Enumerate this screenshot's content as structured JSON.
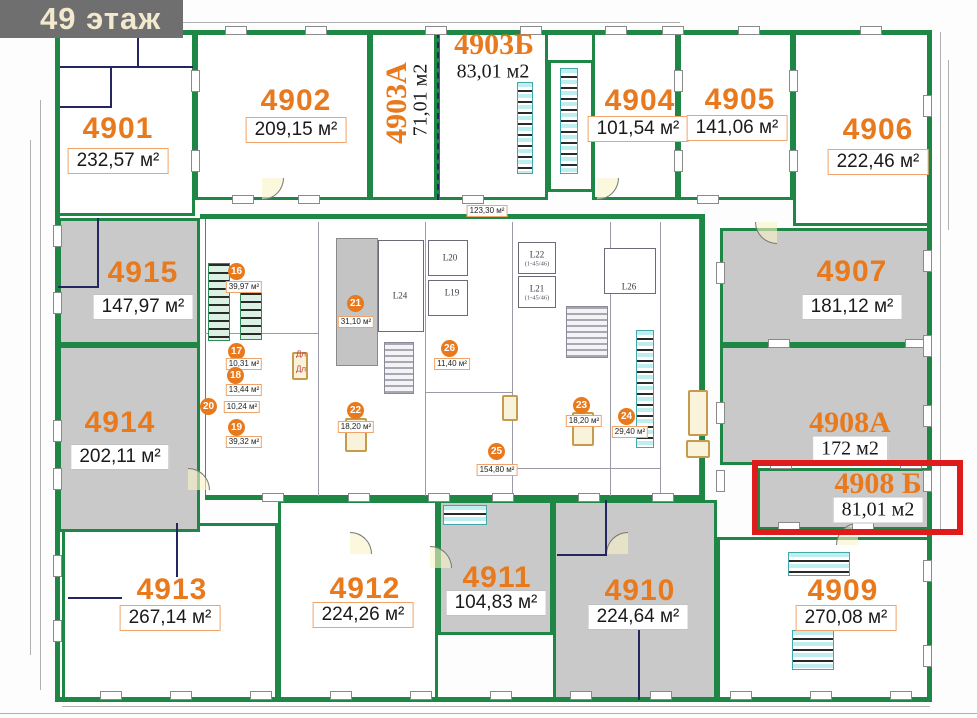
{
  "header": {
    "title": "49 этаж"
  },
  "colors": {
    "accent_orange": "#e8791d",
    "wall_green": "#1f8746",
    "wall_navy": "#26265e",
    "unit_fill_gray": "#c9c9c9",
    "highlight_red": "#e01b1b",
    "header_bg": "#6f6f6f",
    "header_text": "#f3e9ce"
  },
  "plan": {
    "highlight": {
      "unit": "4908 Б",
      "rect": [
        752,
        460,
        211,
        75
      ]
    },
    "units": [
      {
        "id": "4901",
        "area": "232,57 м²",
        "style": "sans",
        "rect": [
          57,
          32,
          138,
          184
        ],
        "fill": "white",
        "num": [
          118,
          129
        ],
        "areapos": [
          118,
          161
        ],
        "chip": "chip-orange"
      },
      {
        "id": "4902",
        "area": "209,15 м²",
        "style": "sans",
        "rect": [
          195,
          32,
          175,
          168
        ],
        "fill": "white",
        "num": [
          296,
          101
        ],
        "areapos": [
          296,
          130
        ],
        "chip": "chip-orange"
      },
      {
        "id": "4903А",
        "area": "71,01 м2",
        "style": "serif",
        "rotated": true,
        "rect": [
          370,
          32,
          67,
          168
        ],
        "fill": "white",
        "num": [
          397,
          103
        ],
        "areapos": [
          421,
          100
        ],
        "chip": "chip-none"
      },
      {
        "id": "4903Б",
        "area": "83,01 м2",
        "style": "serif",
        "rect": [
          437,
          32,
          111,
          168
        ],
        "fill": "white",
        "num": [
          494,
          45
        ],
        "areapos": [
          493,
          72
        ],
        "chip": "chip-none"
      },
      {
        "id": "4904",
        "area": "101,54 м²",
        "style": "sans",
        "rect": [
          592,
          32,
          86,
          168
        ],
        "fill": "white",
        "num": [
          640,
          101
        ],
        "areapos": [
          638,
          129
        ],
        "chip": "chip-orange"
      },
      {
        "id": "4905",
        "area": "141,06 м²",
        "style": "sans",
        "rect": [
          678,
          32,
          115,
          168
        ],
        "fill": "white",
        "num": [
          740,
          100
        ],
        "areapos": [
          737,
          128
        ],
        "chip": "chip-orange"
      },
      {
        "id": "4906",
        "area": "222,46 м²",
        "style": "sans",
        "rect": [
          793,
          32,
          137,
          194
        ],
        "fill": "white",
        "num": [
          878,
          130
        ],
        "areapos": [
          878,
          162
        ],
        "chip": "chip-orange"
      },
      {
        "id": "4907",
        "area": "181,12 м²",
        "style": "sans",
        "rect": [
          720,
          228,
          210,
          117
        ],
        "fill": "gray",
        "num": [
          852,
          272
        ],
        "areapos": [
          852,
          307
        ],
        "chip": "chip-plain"
      },
      {
        "id": "4908А",
        "area": "172 м2",
        "style": "serif",
        "rect": [
          720,
          345,
          210,
          120
        ],
        "fill": "gray",
        "num": [
          850,
          423
        ],
        "areapos": [
          850,
          449
        ],
        "chip": "chip-plain"
      },
      {
        "id": "4908 Б",
        "area": "81,01 м2",
        "style": "serif",
        "rect": [
          757,
          468,
          173,
          62
        ],
        "fill": "gray",
        "num": [
          878,
          484
        ],
        "areapos": [
          878,
          510
        ],
        "chip": "chip-plain"
      },
      {
        "id": "4909",
        "area": "270,08 м²",
        "style": "sans",
        "rect": [
          717,
          537,
          213,
          163
        ],
        "fill": "white",
        "num": [
          843,
          591
        ],
        "areapos": [
          846,
          618
        ],
        "chip": "chip-orange"
      },
      {
        "id": "4910",
        "area": "224,64 м²",
        "style": "sans",
        "rect": [
          553,
          500,
          164,
          200
        ],
        "fill": "gray",
        "num": [
          640,
          591
        ],
        "areapos": [
          638,
          617
        ],
        "chip": "chip-plain"
      },
      {
        "id": "4911",
        "area": "104,83 м²",
        "style": "sans",
        "rect": [
          438,
          500,
          115,
          135
        ],
        "fill": "gray",
        "num": [
          497,
          578
        ],
        "areapos": [
          496,
          603
        ],
        "chip": "chip-plain"
      },
      {
        "id": "4912",
        "area": "224,26 м²",
        "style": "sans",
        "rect": [
          278,
          500,
          160,
          200
        ],
        "fill": "white",
        "num": [
          365,
          589
        ],
        "areapos": [
          363,
          615
        ],
        "chip": "chip-orange"
      },
      {
        "id": "4913",
        "area": "267,14 м²",
        "style": "sans",
        "rect": [
          62,
          523,
          216,
          177
        ],
        "fill": "white",
        "num": [
          172,
          590
        ],
        "areapos": [
          170,
          618
        ],
        "chip": "chip-orange"
      },
      {
        "id": "4914",
        "area": "202,11 м²",
        "style": "sans",
        "rect": [
          58,
          345,
          142,
          187
        ],
        "fill": "gray",
        "num": [
          120,
          423
        ],
        "areapos": [
          120,
          457
        ],
        "chip": "chip-plain"
      },
      {
        "id": "4915",
        "area": "147,97 м²",
        "style": "sans",
        "rect": [
          58,
          218,
          142,
          127
        ],
        "fill": "gray",
        "num": [
          143,
          273
        ],
        "areapos": [
          143,
          307
        ],
        "chip": "chip-plain"
      }
    ],
    "core_rooms": [
      {
        "num": "16",
        "area": "39,97 м²",
        "circle": [
          237,
          272
        ],
        "chippos": [
          244,
          287
        ]
      },
      {
        "num": "17",
        "area": "10,31 м²",
        "circle": [
          237,
          352
        ],
        "chippos": [
          244,
          364
        ]
      },
      {
        "num": "18",
        "area": "13,44 м²",
        "circle": [
          236,
          376
        ],
        "chippos": [
          244,
          390
        ]
      },
      {
        "num": "19",
        "area": "39,32 м²",
        "circle": [
          237,
          428
        ],
        "chippos": [
          244,
          442
        ]
      },
      {
        "num": "20",
        "area": "10,24 м²",
        "circle": [
          209,
          407
        ],
        "chippos": [
          242,
          407
        ]
      },
      {
        "num": "21",
        "area": "31,10 м²",
        "circle": [
          356,
          304
        ],
        "chippos": [
          356,
          322
        ]
      },
      {
        "num": "22",
        "area": "18,20 м²",
        "circle": [
          356,
          411
        ],
        "chippos": [
          356,
          427
        ]
      },
      {
        "num": "23",
        "area": "18,20 м²",
        "circle": [
          582,
          406
        ],
        "chippos": [
          584,
          421
        ]
      },
      {
        "num": "24",
        "area": "29,40 м²",
        "circle": [
          627,
          417
        ],
        "chippos": [
          630,
          432
        ]
      },
      {
        "num": "25",
        "area": "154,80 м²",
        "circle": [
          497,
          452
        ],
        "chippos": [
          497,
          470
        ]
      },
      {
        "num": "26",
        "area": "11,40 м²",
        "circle": [
          450,
          349
        ],
        "chippos": [
          452,
          364
        ]
      }
    ],
    "corridor_label": {
      "area": "123,30 м²",
      "chippos": [
        487,
        211
      ]
    },
    "elevators": [
      {
        "label": "L20",
        "pos": [
          450,
          258
        ]
      },
      {
        "label": "L19",
        "pos": [
          452,
          293
        ]
      },
      {
        "label": "L22",
        "sub": "(1-45/46)",
        "pos": [
          537,
          255
        ]
      },
      {
        "label": "L21",
        "sub": "(1-45/46)",
        "pos": [
          537,
          289
        ]
      },
      {
        "label": "L24",
        "pos": [
          400,
          296
        ]
      },
      {
        "label": "L26",
        "pos": [
          629,
          287
        ]
      }
    ],
    "annotations": [
      {
        "text": "Дл",
        "pos": [
          301,
          354
        ]
      },
      {
        "text": "Дл",
        "pos": [
          301,
          369
        ]
      }
    ],
    "geometry": {
      "outer": [
        55,
        30,
        877,
        672
      ],
      "core": [
        205,
        218,
        495,
        282
      ],
      "green_walls": [
        [
          200,
          214,
          505,
          5
        ],
        [
          205,
          495,
          497,
          5
        ],
        [
          700,
          218,
          5,
          282
        ]
      ],
      "green_rooms": [
        [
          548,
          60,
          46,
          132
        ]
      ],
      "gray_rooms": [
        [
          336,
          238,
          42,
          128
        ]
      ],
      "shafts": [
        [
          428,
          240,
          40,
          36
        ],
        [
          428,
          280,
          40,
          36
        ],
        [
          518,
          242,
          38,
          32
        ],
        [
          518,
          276,
          38,
          32
        ],
        [
          604,
          248,
          52,
          46
        ],
        [
          378,
          240,
          46,
          92
        ]
      ],
      "stairs": [
        [
          384,
          342,
          30,
          52
        ],
        [
          566,
          306,
          42,
          52
        ]
      ],
      "cyan_strips": [
        [
          517,
          82,
          16,
          92
        ],
        [
          560,
          68,
          18,
          106
        ],
        [
          636,
          330,
          18,
          118
        ],
        [
          443,
          505,
          44,
          20
        ],
        [
          788,
          552,
          62,
          24
        ],
        [
          792,
          630,
          42,
          40
        ]
      ],
      "green_strips": [
        [
          208,
          263,
          22,
          78
        ],
        [
          240,
          292,
          22,
          48
        ]
      ],
      "core_lines": [
        [
          318,
          222,
          1,
          274
        ],
        [
          425,
          222,
          1,
          274
        ],
        [
          512,
          222,
          1,
          274
        ],
        [
          610,
          222,
          1,
          274
        ],
        [
          660,
          222,
          1,
          274
        ],
        [
          205,
          333,
          113,
          1
        ],
        [
          425,
          392,
          87,
          1
        ],
        [
          512,
          468,
          148,
          1
        ]
      ],
      "navy_lines": [
        [
          60,
          66,
          133,
          2
        ],
        [
          137,
          34,
          2,
          34
        ],
        [
          110,
          66,
          2,
          40
        ],
        [
          60,
          106,
          52,
          2
        ],
        [
          97,
          218,
          2,
          70
        ],
        [
          58,
          286,
          40,
          2
        ],
        [
          68,
          597,
          54,
          2
        ],
        [
          176,
          523,
          2,
          54
        ],
        [
          557,
          554,
          50,
          2
        ],
        [
          605,
          500,
          2,
          56
        ],
        [
          638,
          612,
          2,
          88
        ]
      ],
      "facade_lines": [
        [
          40,
          100,
          1,
          590
        ],
        [
          30,
          140,
          1,
          515
        ],
        [
          55,
          22,
          625,
          1
        ],
        [
          940,
          32,
          1,
          500
        ],
        [
          948,
          60,
          1,
          170
        ],
        [
          62,
          706,
          868,
          1
        ],
        [
          0,
          713,
          977,
          1
        ]
      ],
      "windows_h": [
        [
          112,
          26
        ],
        [
          225,
          26
        ],
        [
          305,
          26
        ],
        [
          425,
          26
        ],
        [
          520,
          26
        ],
        [
          605,
          26
        ],
        [
          662,
          26
        ],
        [
          738,
          26
        ],
        [
          860,
          26
        ],
        [
          100,
          691
        ],
        [
          170,
          691
        ],
        [
          250,
          691
        ],
        [
          330,
          691
        ],
        [
          410,
          691
        ],
        [
          490,
          691
        ],
        [
          570,
          691
        ],
        [
          650,
          691
        ],
        [
          730,
          691
        ],
        [
          810,
          691
        ],
        [
          890,
          691
        ],
        [
          232,
          195
        ],
        [
          298,
          195
        ],
        [
          462,
          195
        ],
        [
          697,
          195
        ],
        [
          262,
          493
        ],
        [
          348,
          493
        ],
        [
          428,
          493
        ],
        [
          492,
          493
        ],
        [
          578,
          493
        ],
        [
          652,
          493
        ],
        [
          778,
          522
        ],
        [
          852,
          522
        ],
        [
          768,
          339
        ],
        [
          905,
          339
        ],
        [
          770,
          460
        ],
        [
          900,
          460
        ]
      ],
      "windows_v": [
        [
          53,
          225
        ],
        [
          53,
          292
        ],
        [
          53,
          420
        ],
        [
          53,
          468
        ],
        [
          53,
          555
        ],
        [
          53,
          620
        ],
        [
          923,
          95
        ],
        [
          923,
          250
        ],
        [
          923,
          335
        ],
        [
          923,
          405
        ],
        [
          923,
          470
        ],
        [
          923,
          560
        ],
        [
          923,
          645
        ],
        [
          716,
          262
        ],
        [
          716,
          402
        ],
        [
          716,
          470
        ],
        [
          191,
          70
        ],
        [
          191,
          150
        ],
        [
          674,
          70
        ],
        [
          674,
          150
        ],
        [
          789,
          70
        ],
        [
          789,
          150
        ]
      ],
      "arcs": [
        [
          262,
          178,
          "br"
        ],
        [
          597,
          178,
          "br"
        ],
        [
          755,
          222,
          "bl"
        ],
        [
          350,
          532,
          "tr"
        ],
        [
          606,
          532,
          "tl"
        ],
        [
          188,
          468,
          "tr"
        ],
        [
          836,
          523,
          "tl"
        ],
        [
          430,
          546,
          "tr"
        ]
      ],
      "furniture": [
        [
          345,
          418,
          22,
          34
        ],
        [
          572,
          412,
          22,
          34
        ],
        [
          688,
          390,
          20,
          46
        ],
        [
          686,
          440,
          24,
          18
        ],
        [
          502,
          395,
          16,
          26
        ],
        [
          292,
          352,
          16,
          28
        ]
      ],
      "dashed_v": [
        [
          437,
          32,
          168
        ]
      ]
    }
  }
}
